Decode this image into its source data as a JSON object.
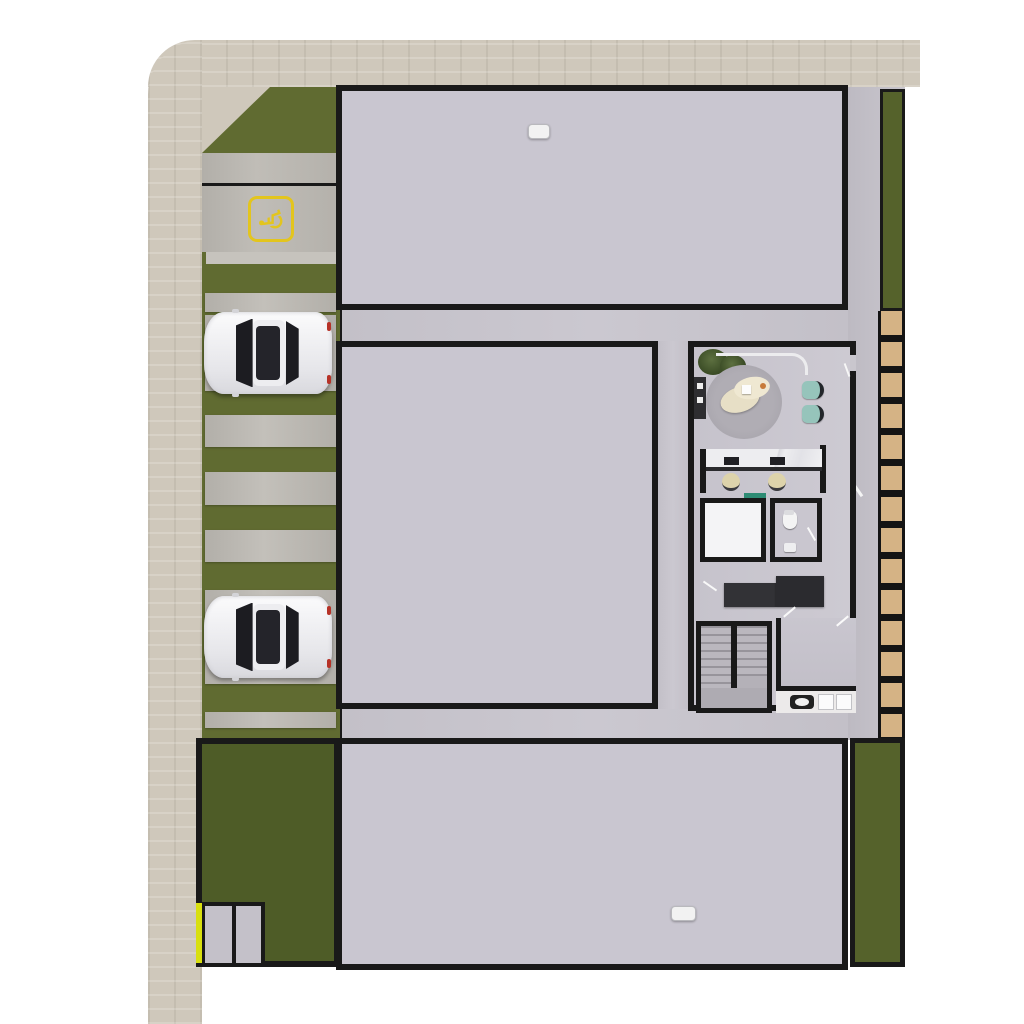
{
  "meta": {
    "title": "Residential micro-unit building — furnished site / floor plan rendering",
    "view": "top-down architectural render",
    "visible_text": "none"
  },
  "colors": {
    "wall": "#191919",
    "sidewalk": "#cfc8bb",
    "grass": "#606b31",
    "grassPatio": "#5c6a2e",
    "grassDark": "#55622b",
    "grassYard": "#4e5c27",
    "floor": "#c9c6d0",
    "concrete": "#b7b4ae",
    "wood": "#a3774a",
    "paver": "#d5b385",
    "accessYellow": "#e3c51d",
    "gateYellow": "#d8df0e",
    "chairOrange": "#dd7a2c",
    "chairTeal": "#96c4bb",
    "tailRed": "#b63227"
  },
  "site": {
    "sidewalk": {
      "label": "perimeter sidewalk",
      "corner": "rounded top-left"
    },
    "parking": {
      "label": "street parking strip",
      "handicap_glyph": "♿",
      "accessible_spaces": 1,
      "cars_parked": 2,
      "pads": [
        {
          "top": 206,
          "h": 19,
          "car": false
        },
        {
          "top": 228,
          "h": 76,
          "car": true
        },
        {
          "top": 328,
          "h": 32,
          "car": false
        },
        {
          "top": 385,
          "h": 33,
          "car": false
        },
        {
          "top": 443,
          "h": 32,
          "car": false
        },
        {
          "top": 503,
          "h": 94,
          "car": true
        },
        {
          "top": 625,
          "h": 16,
          "car": false
        }
      ]
    },
    "walkway": {
      "label": "east walkway",
      "stepping_paver_count": 14
    },
    "yard": {
      "label": "south-west fenced yard",
      "utility_rooms": 2
    }
  },
  "building": {
    "top_row": {
      "label": "north unit row",
      "unit_count": 7,
      "furnished_unit_index": 3
    },
    "bottom_row": {
      "label": "south unit row",
      "unit_count": 7,
      "furnished_unit_index": 5
    },
    "mid_block": {
      "label": "west studio block",
      "row_count": 5,
      "furnished_row_index": 1
    },
    "amenity_block": {
      "label": "core / amenity block",
      "areas": [
        "shared lounge",
        "coworking desks",
        "storage room",
        "wc",
        "lockers",
        "staircase",
        "laundry counter"
      ]
    },
    "unit_features": [
      "private patio",
      "bathroom",
      "main room"
    ],
    "furnished_unit_features": [
      "bed",
      "wardrobe",
      "kitchenette with cooktop",
      "timber deck strip",
      "waste bin"
    ]
  }
}
